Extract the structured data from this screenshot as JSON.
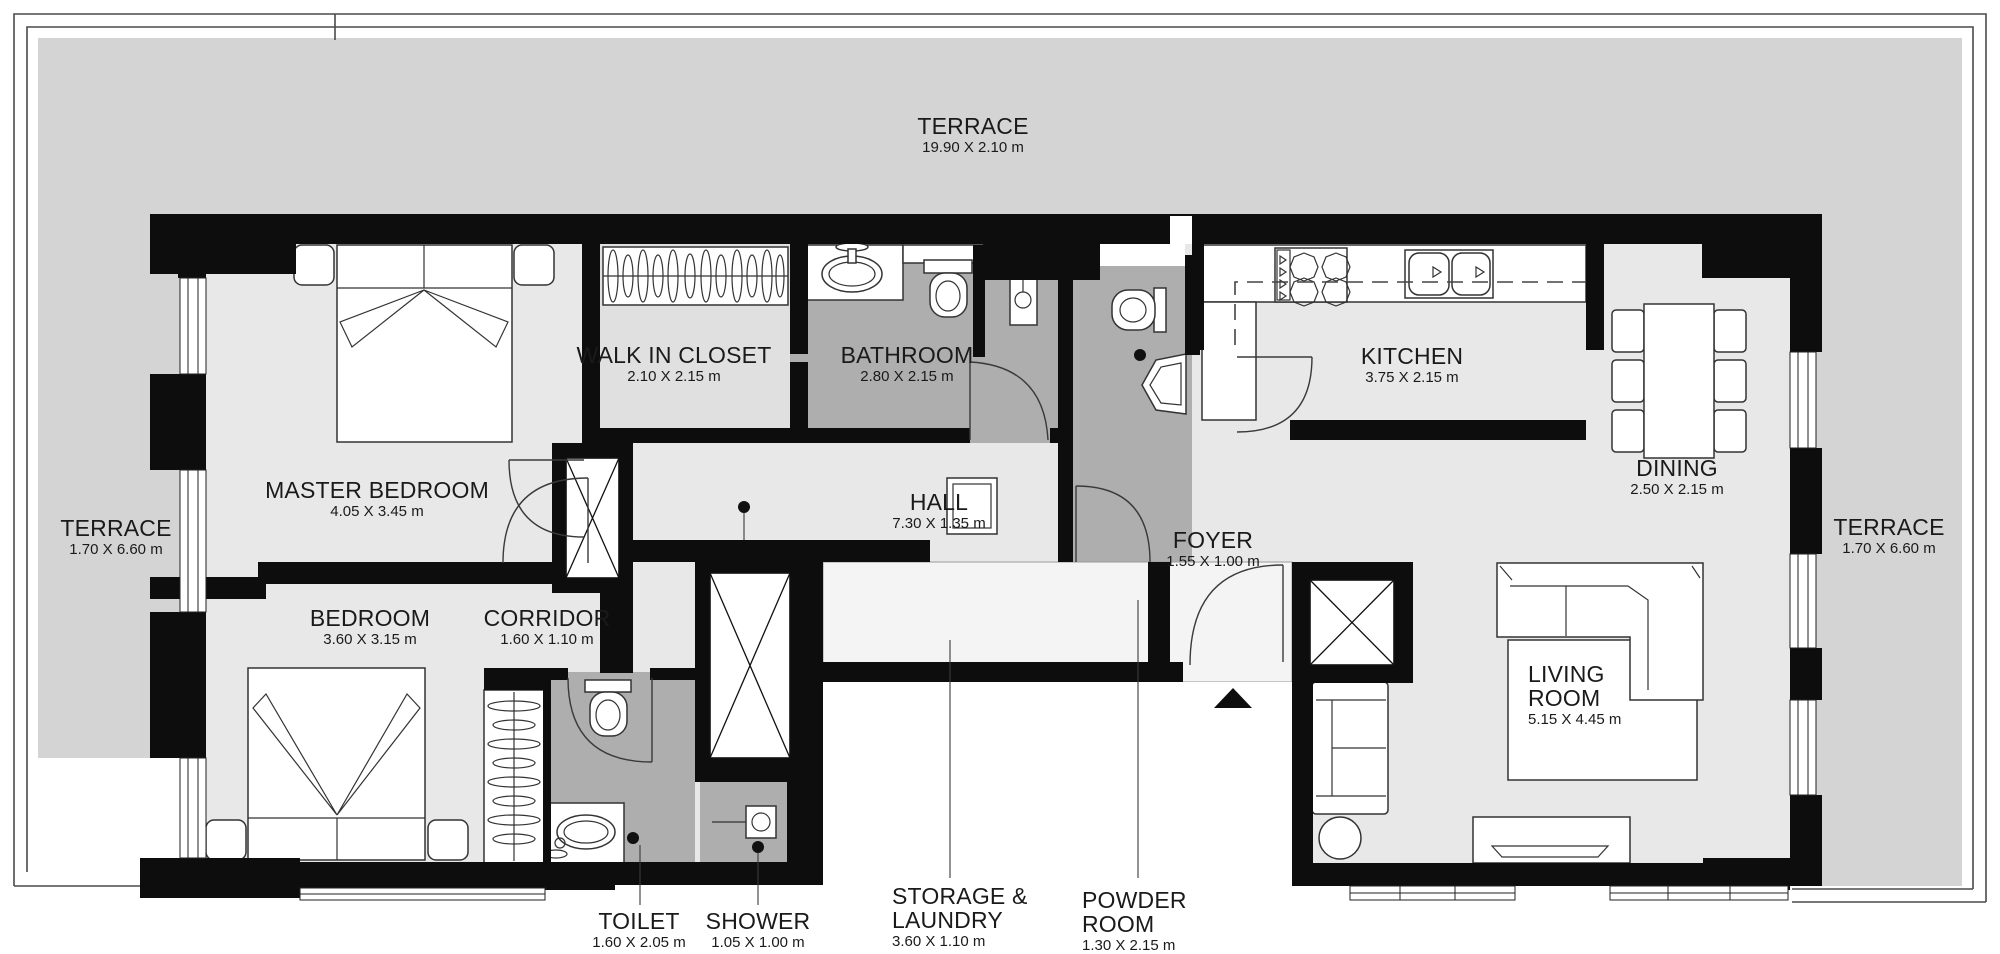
{
  "plan": {
    "type": "apartment-floor-plan",
    "colors": {
      "wall": "#0d0d0d",
      "terrace": "#d4d4d4",
      "floor": "#e8e8e8",
      "floor_wet": "#aeaeae",
      "floor_closet": "#e0e0e0",
      "storage_floor": "#f4f4f4",
      "label": "#1a1a1a"
    },
    "rooms": {
      "terrace_top": {
        "name": "TERRACE",
        "dims": "19.90 X 2.10 m"
      },
      "terrace_left": {
        "name": "TERRACE",
        "dims": "1.70 X 6.60 m"
      },
      "terrace_right": {
        "name": "TERRACE",
        "dims": "1.70 X 6.60 m"
      },
      "master_bedroom": {
        "name": "MASTER BEDROOM",
        "dims": "4.05 X 3.45 m"
      },
      "walk_in_closet": {
        "name": "WALK IN CLOSET",
        "dims": "2.10 X 2.15 m"
      },
      "bathroom": {
        "name": "BATHROOM",
        "dims": "2.80 X 2.15 m"
      },
      "kitchen": {
        "name": "KITCHEN",
        "dims": "3.75 X 2.15 m"
      },
      "dining": {
        "name": "DINING",
        "dims": "2.50 X 2.15 m"
      },
      "hall": {
        "name": "HALL",
        "dims": "7.30 X 1.35 m"
      },
      "foyer": {
        "name": "FOYER",
        "dims": "1.55 X 1.00 m"
      },
      "bedroom": {
        "name": "BEDROOM",
        "dims": "3.60 X 3.15 m"
      },
      "corridor": {
        "name": "CORRIDOR",
        "dims": "1.60 X 1.10 m"
      },
      "living_room": {
        "name": "LIVING\nROOM",
        "dims": "5.15 X 4.45 m"
      },
      "toilet": {
        "name": "TOILET",
        "dims": "1.60 X 2.05 m"
      },
      "shower": {
        "name": "SHOWER",
        "dims": "1.05 X 1.00 m"
      },
      "storage_laundry": {
        "name": "STORAGE &\nLAUNDRY",
        "dims": "3.60 X 1.10 m"
      },
      "powder_room": {
        "name": "POWDER\nROOM",
        "dims": "1.30 X 2.15 m"
      }
    }
  }
}
